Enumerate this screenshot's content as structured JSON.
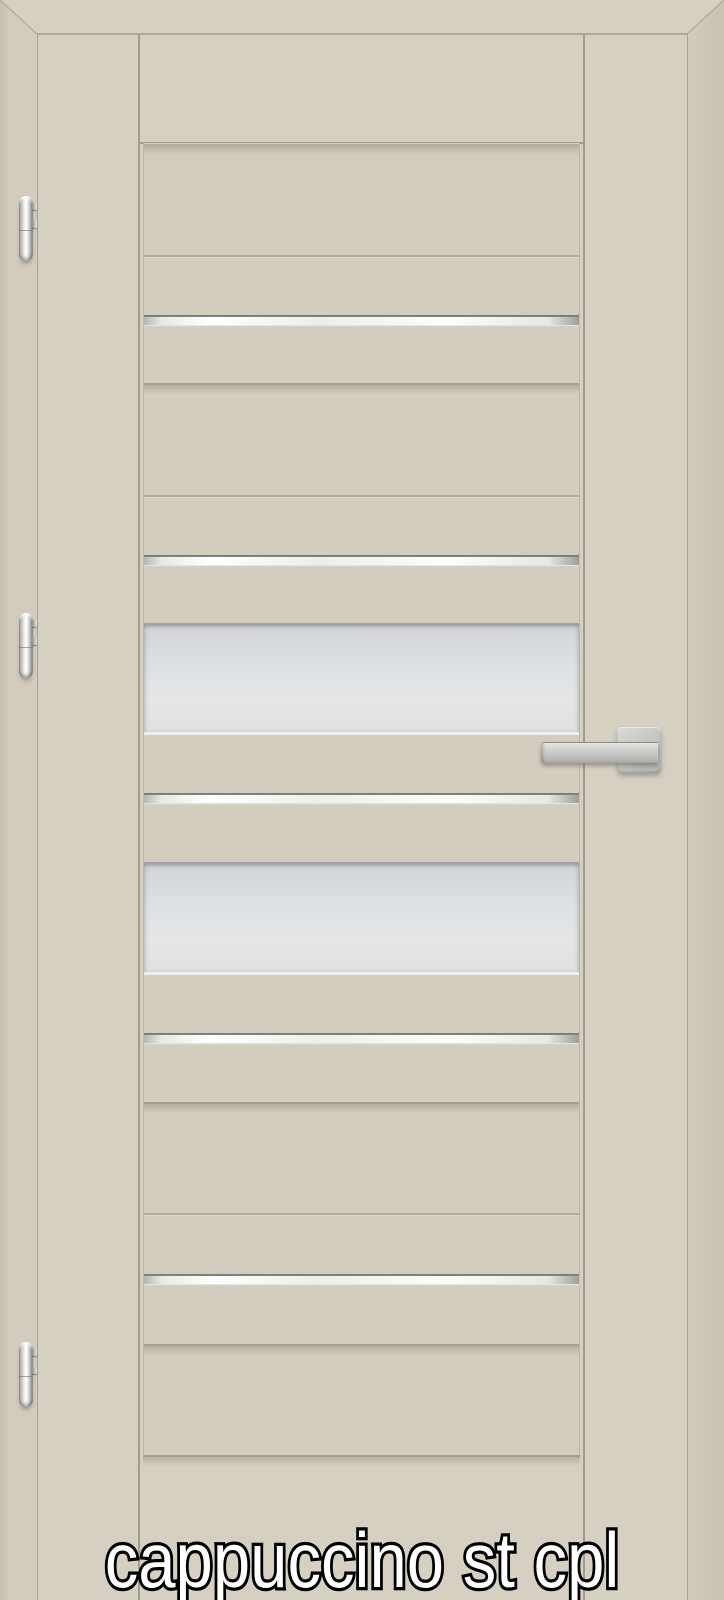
{
  "caption": {
    "text": "cappuccino st cpl"
  },
  "door": {
    "finish_label": "cappuccino st cpl",
    "glass_pane_count": 2,
    "chrome_strip_count": 5,
    "hinge_count": 3,
    "hinge_side": "left",
    "handle_side": "right"
  },
  "colors": {
    "wall": "#d2cbbe",
    "frame": "#d6d0c3",
    "leaf": "#d6d0c3",
    "panel": "#d3cdc0",
    "glassA": "#d2d4d7",
    "glassB": "#e5e6e8",
    "textFill": "#ffffff",
    "textOutline": "#000000"
  }
}
